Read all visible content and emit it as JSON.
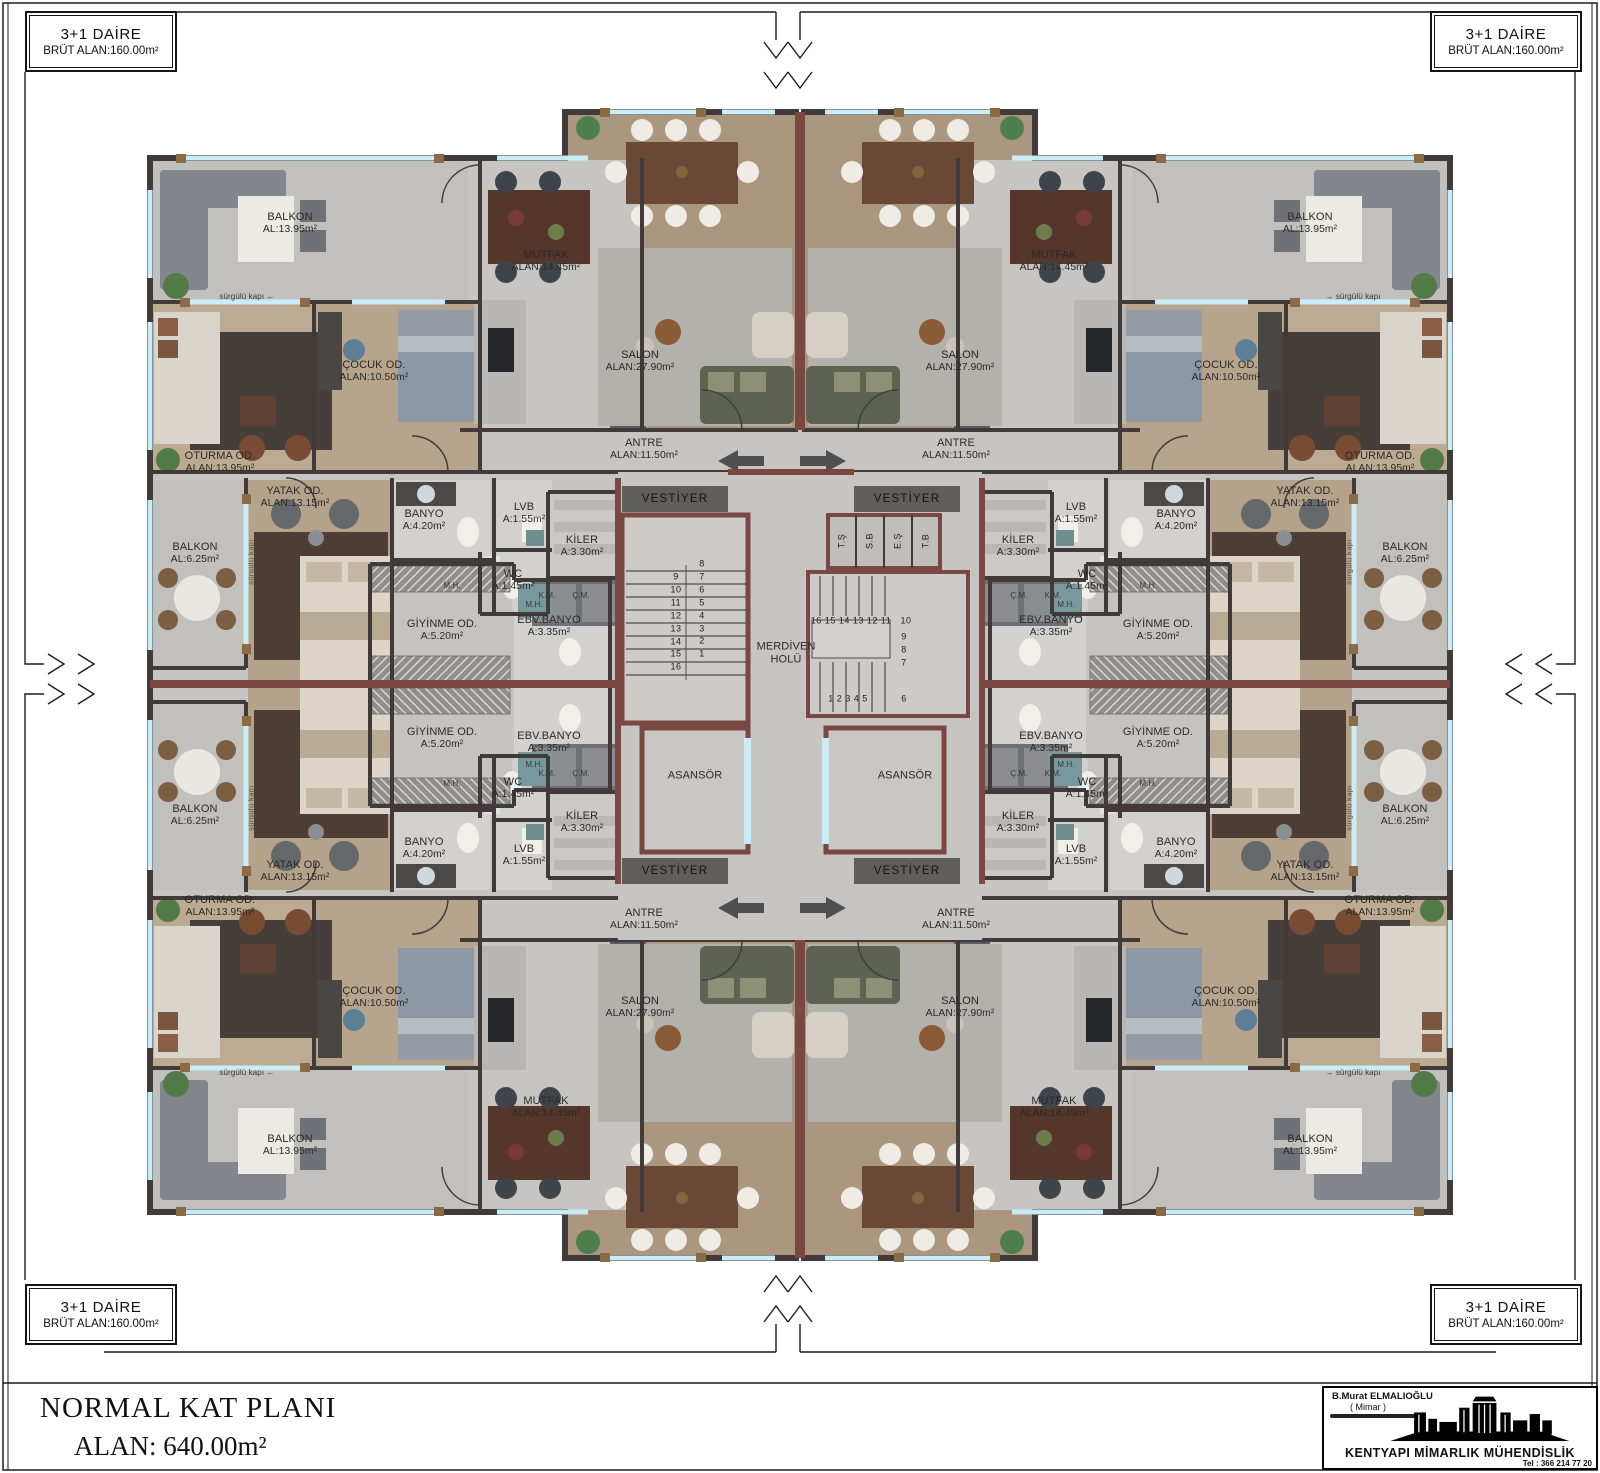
{
  "sheet": {
    "corner_label": {
      "line1": "3+1 DAİRE",
      "line2": "BRÜT ALAN:160.00m²"
    },
    "title_block": {
      "line1": "NORMAL KAT PLANI",
      "line2": "ALAN: 640.00m²"
    },
    "logo": {
      "architect": "B.Murat ELMALIOĞLU",
      "role": "( Mimar )",
      "company": "KENTYAPI MİMARLIK MÜHENDİSLİK",
      "phone": "Tel : 366 214 77 20"
    }
  },
  "colors": {
    "wall_dark": "#413a39",
    "wall_maroon": "#7a4742",
    "floor_gray": "#c7c5c1",
    "floor_wood": "#b2a08a",
    "window_glass": "#c9ecf6",
    "window_frame": "#8a6b46",
    "vestiyer_band": "#605e5b"
  },
  "rooms": [
    {
      "name": "BALKON",
      "area": "AL:13.95m²",
      "x": 290,
      "y": 224,
      "mirror": "both"
    },
    {
      "name": "MUTFAK",
      "area": "ALAN:14.45m²",
      "x": 546,
      "y": 262,
      "mirror": "both"
    },
    {
      "name": "ÇOCUK OD.",
      "area": "ALAN:10.50m²",
      "x": 374,
      "y": 372,
      "mirror": "both"
    },
    {
      "name": "SALON",
      "area": "ALAN:27.90m²",
      "x": 640,
      "y": 362,
      "mirror": "both"
    },
    {
      "name": "OTURMA OD.",
      "area": "ALAN:13.95m²",
      "x": 220,
      "y": 463,
      "mirror": "both"
    },
    {
      "name": "ANTRE",
      "area": "ALAN:11.50m²",
      "x": 644,
      "y": 450,
      "mirror": "both"
    },
    {
      "name": "YATAK OD.",
      "area": "ALAN:13.15m²",
      "x": 295,
      "y": 498,
      "mirror": "both"
    },
    {
      "name": "BALKON",
      "area": "AL:6.25m²",
      "x": 195,
      "y": 554,
      "mirror": "both"
    },
    {
      "name": "BANYO",
      "area": "A:4.20m²",
      "x": 424,
      "y": 521,
      "mirror": "both"
    },
    {
      "name": "LVB",
      "area": "A:1.55m²",
      "x": 524,
      "y": 514,
      "mirror": "both"
    },
    {
      "name": "KİLER",
      "area": "A:3.30m²",
      "x": 582,
      "y": 547,
      "mirror": "both"
    },
    {
      "name": "WC",
      "area": "A:1.45m²",
      "x": 513,
      "y": 581,
      "mirror": "both"
    },
    {
      "name": "GİYİNME OD.",
      "area": "A:5.20m²",
      "x": 442,
      "y": 631,
      "mirror": "both"
    },
    {
      "name": "EBV.BANYO",
      "area": "A:3.35m²",
      "x": 549,
      "y": 627,
      "mirror": "both"
    },
    {
      "name": "K.M.",
      "x": 547,
      "y": 596,
      "mirror": "both",
      "cls": "sm"
    },
    {
      "name": "Ç.M.",
      "x": 581,
      "y": 596,
      "mirror": "both",
      "cls": "sm"
    },
    {
      "name": "M.H.",
      "x": 452,
      "y": 586,
      "mirror": "both",
      "cls": "sm"
    },
    {
      "name": "M.H.",
      "x": 534,
      "y": 605,
      "mirror": "both",
      "cls": "sm"
    },
    {
      "name": "sürgülü kapı",
      "x": 247,
      "y": 297,
      "mirror": "both",
      "cls": "sm",
      "arrow": true
    },
    {
      "name": "sürgülü kapı",
      "x": 251,
      "y": 562,
      "mirror": "both",
      "cls": "rot"
    },
    {
      "name": "VESTİYER",
      "x": 675,
      "y": 499,
      "mirror": "none",
      "cls": "band"
    },
    {
      "name": "VESTİYER",
      "x": 907,
      "y": 499,
      "mirror": "none",
      "cls": "band"
    },
    {
      "name": "VESTİYER",
      "x": 675,
      "y": 871,
      "mirror": "none",
      "cls": "band"
    },
    {
      "name": "VESTİYER",
      "x": 907,
      "y": 871,
      "mirror": "none",
      "cls": "band"
    },
    {
      "name": "ASANSÖR",
      "x": 695,
      "y": 776,
      "mirror": "x"
    },
    {
      "name": "MERDİVEN",
      "area": "HOLÜ",
      "x": 786,
      "y": 654,
      "mirror": "none",
      "cls": "mid"
    }
  ],
  "core": {
    "shafts": [
      "T.Ş",
      "S.B",
      "E.Ş",
      "T.B"
    ],
    "stairs": {
      "left_a": [
        "9",
        "10",
        "11",
        "12",
        "13",
        "14",
        "15",
        "16"
      ],
      "left_b": [
        "8",
        "7",
        "6",
        "5",
        "4",
        "3",
        "2",
        "1"
      ],
      "right": [
        {
          "t": "16 15 14 13 12 11",
          "x": 851,
          "y": 621
        },
        {
          "t": "10",
          "x": 906,
          "y": 621
        },
        {
          "t": "9",
          "x": 904,
          "y": 637
        },
        {
          "t": "8",
          "x": 904,
          "y": 650
        },
        {
          "t": "7",
          "x": 904,
          "y": 663
        },
        {
          "t": "1 2 3 4 5",
          "x": 848,
          "y": 699
        },
        {
          "t": "6",
          "x": 904,
          "y": 699
        }
      ]
    }
  }
}
